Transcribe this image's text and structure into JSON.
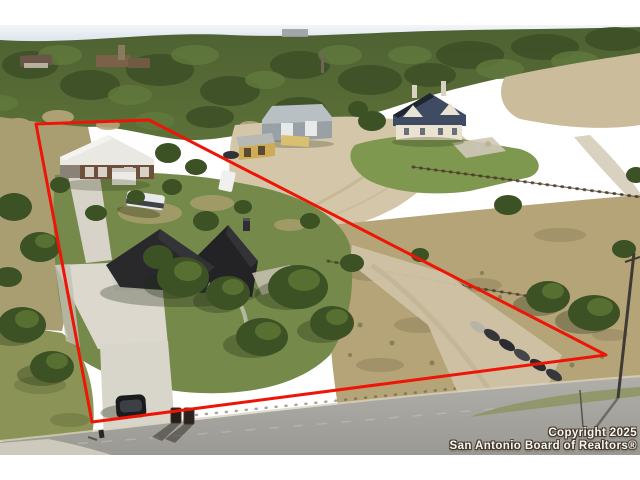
{
  "photo": {
    "kind": "aerial-drone-photo",
    "subject": "hill-country property listing with red lot outline"
  },
  "watermark": {
    "line1": "Copyright 2025",
    "line2": "San Antonio Board of Realtors®"
  },
  "boundary": {
    "color": "#ee1506",
    "width": 3,
    "points": "36,99 149,95 606,330 92,397"
  },
  "palette": {
    "boundary_red": "#ee1506",
    "sky": "#dde7ee",
    "canopy_green": "#46592e",
    "field_tan": "#c9bb9b",
    "lawn_green": "#7e9850",
    "caliche": "#d4c7a9",
    "road_gray": "#a3a29d",
    "roof_charcoal": "#29292c",
    "barn_roof_white": "#e9e8e3",
    "watermark_text": "#f8f6f2",
    "watermark_outline": "#45392b"
  }
}
